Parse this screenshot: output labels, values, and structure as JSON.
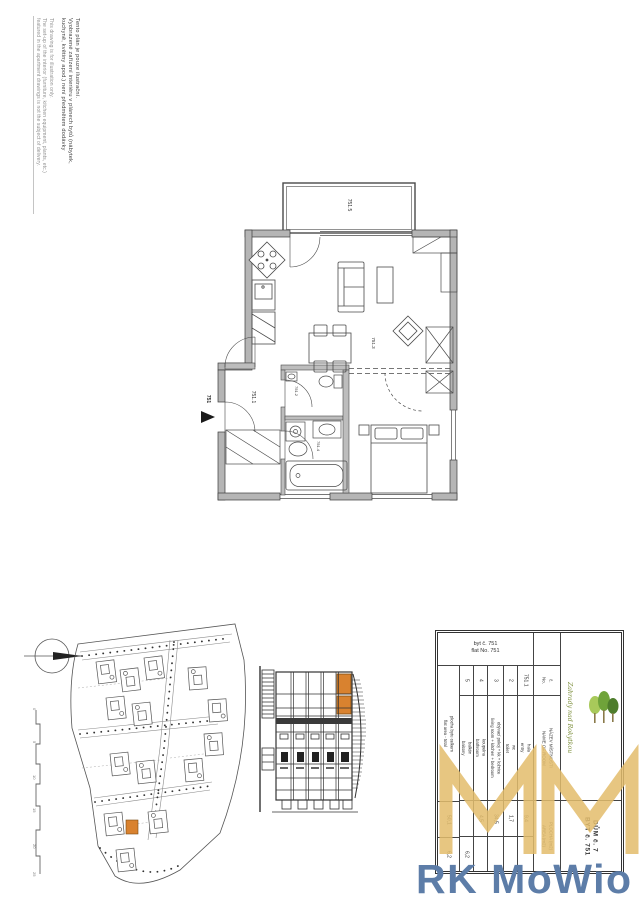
{
  "disclaimer": {
    "cs": [
      "Tento plán je pouze ilustrační.",
      "Vyobrazené zařízení interiéru v plánech bytů (nábytek,",
      "kuchyně, květiny apod.) není předmětem dodávky"
    ],
    "en": [
      "This drawing is for illustration only.",
      "The set-up of the interior (furniture, kitchen equipment, plants, etc.)",
      "featured in the apartment drawings is not the subject of delivery."
    ]
  },
  "floor_plan": {
    "entry_label": "751",
    "room_labels": {
      "hall": "751.1",
      "wc": "751.2",
      "living": "751.3",
      "bath": "751.4",
      "terrace": "751.5"
    }
  },
  "site_plan": {
    "scale_ticks": [
      "0",
      "5",
      "10",
      "15",
      "20",
      "25"
    ]
  },
  "room_table": {
    "caption_cs": "byt č. 751",
    "caption_en": "flat No. 751",
    "headers": {
      "no_cs": "č.",
      "no_en": "No.",
      "name_cs": "NÁZEV MÍSTNOSTI",
      "name_en": "NAME OF ROOM",
      "area_cs": "PLOCHA (m2)",
      "area_en": "AREA (m2)"
    },
    "rows": [
      {
        "no": "751.1",
        "cs": "hala",
        "en": "entry",
        "area": "9,4",
        "balc": ""
      },
      {
        "no": "2",
        "cs": "wc",
        "en": "toilet",
        "area": "1,7",
        "balc": ""
      },
      {
        "no": "3",
        "cs": "obývací pokoj + kk + ložnice",
        "en": "living room + kitchen + bedroom",
        "area": "34,5",
        "balc": ""
      },
      {
        "no": "4",
        "cs": "koupelna",
        "en": "bathroom",
        "area": "4,5",
        "balc": ""
      },
      {
        "no": "5",
        "cs": "balkón",
        "en": "balcony",
        "area": "",
        "balc": "6,2"
      }
    ],
    "total": {
      "cs": "plocha bytu celkem",
      "en": "flat area - total",
      "area": "50,1",
      "balc": "6,2"
    },
    "unit": {
      "house": "DŮM č. 7",
      "flat": "BYT č. 751"
    },
    "developer_logo": "Zahrady nad Rokytkou"
  },
  "branding": {
    "agency": "RK MoWio",
    "accent_gold": "#e3bd6c",
    "accent_blue": "#5d7da8",
    "highlight_orange": "#d9822f"
  }
}
